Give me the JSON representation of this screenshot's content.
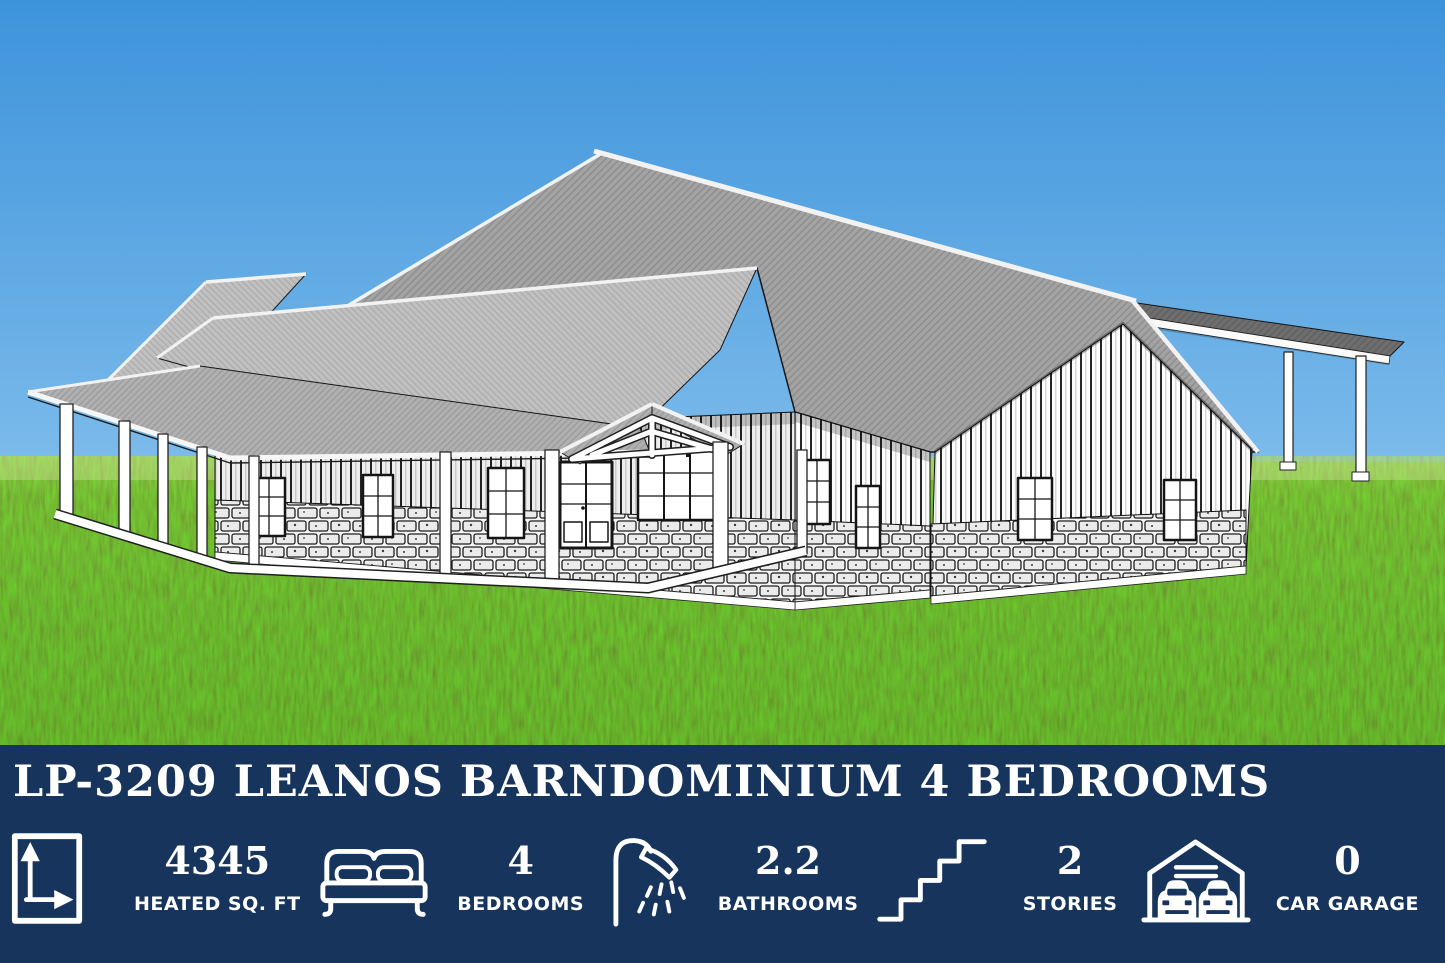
{
  "banner": {
    "title": "LP-3209 LEANOS BARNDOMINIUM 4 BEDROOMS",
    "background_color": "#17345C",
    "text_color": "#FFFFFF",
    "stats": [
      {
        "icon": "floor-area-icon",
        "value": "4345",
        "label": "HEATED SQ. FT"
      },
      {
        "icon": "bed-icon",
        "value": "4",
        "label": "BEDROOMS"
      },
      {
        "icon": "shower-icon",
        "value": "2.2",
        "label": "BATHROOMS"
      },
      {
        "icon": "stairs-icon",
        "value": "2",
        "label": "STORIES"
      },
      {
        "icon": "garage-icon",
        "value": "0",
        "label": "CAR GARAGE"
      }
    ]
  },
  "illustration": {
    "alt": "Black-and-white architectural 3D rendering of a barndominium with metal gable roofs, board-and-batten siding, stone wainscot, wrap-around covered porch with white columns, front entry gable truss, and an attached carport, set on a grassy lawn under a blue sky",
    "sky_top_color": "#3D93DB",
    "sky_horizon_color": "#A9D6F2",
    "grass_color": "#58A72A",
    "roof_color": "#A3A3A3",
    "carport_roof_color": "#6E6E6E",
    "siding_color": "#FDFDFD"
  }
}
